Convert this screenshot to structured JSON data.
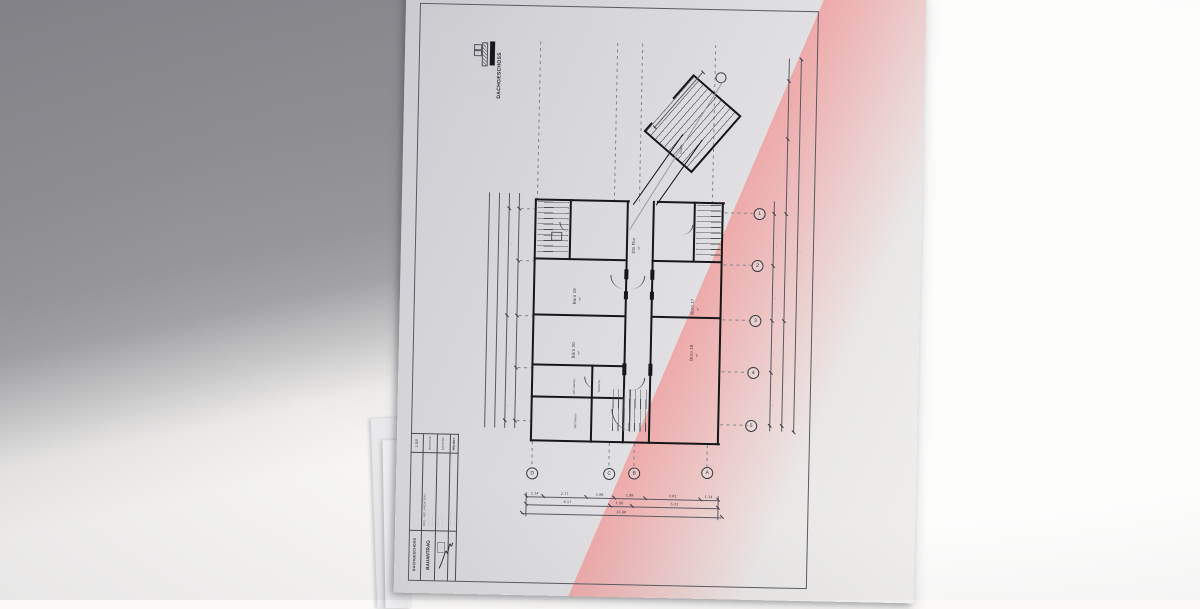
{
  "scene": {
    "description": "Photograph of an architectural floor-plan drawing lying on a desk",
    "backdrop_gray": "#8e8e92",
    "backdrop_white": "#fbfaf8",
    "paper": "#dddcde",
    "ink": "#16161b"
  },
  "legend": {
    "title": "DACHGESCHOSS",
    "swatch_labels": [
      "·····",
      "····",
      "···"
    ]
  },
  "axes": {
    "cols": [
      "1",
      "2",
      "3",
      "4",
      "5"
    ],
    "rows": [
      "D",
      "C",
      "B",
      "A"
    ]
  },
  "rooms": {
    "buero19": {
      "name": "Büro 19",
      "area": "· · m²"
    },
    "buero20": {
      "name": "Büro 20",
      "area": "· · m²"
    },
    "buero17": {
      "name": "Büro 17",
      "area": "· · m²"
    },
    "buero18": {
      "name": "Büro 18",
      "area": "· · m²"
    },
    "wc_damen": {
      "name": "WC Damen"
    },
    "wc_herren": {
      "name": "WC Herren"
    },
    "teekueche": {
      "name": "Teeküche"
    },
    "dg_flur": {
      "name": "DG Flur",
      "area": "· · m²"
    },
    "treppe": {
      "name": "Treppe"
    },
    "tag_left": "···",
    "tag_right": "···"
  },
  "dims": {
    "bottom_row1": [
      "1.14",
      "2.77",
      "1.86",
      "1.98",
      "3.61",
      "1.14"
    ],
    "bottom_row2": [
      "5.17",
      "1.36",
      "5.31"
    ],
    "bottom_total": "13.68",
    "right_marks": [
      "···",
      "···",
      "···",
      "···"
    ],
    "right_upper": [
      "···",
      "···"
    ],
    "right_total": "···",
    "left_marks": [
      "···",
      "···",
      "···",
      "···"
    ]
  },
  "title_block": {
    "scale": "1:100",
    "scale_label": "MASSSTAB",
    "client_label": "BAUHERR",
    "project_label": "PROJEKT",
    "doc_type": "BAUANTRAG",
    "sheet_name": "DACHGESCHOSS",
    "architect_lines": [
      "DIPL.-ING. ARCHITEKT",
      "····· ··· ·····",
      "··· ·······"
    ],
    "client_lines": [
      "···· ·····",
      "······ ···"
    ],
    "project_lines": [
      "········ ······",
      "····· ········",
      "······ ···"
    ]
  }
}
